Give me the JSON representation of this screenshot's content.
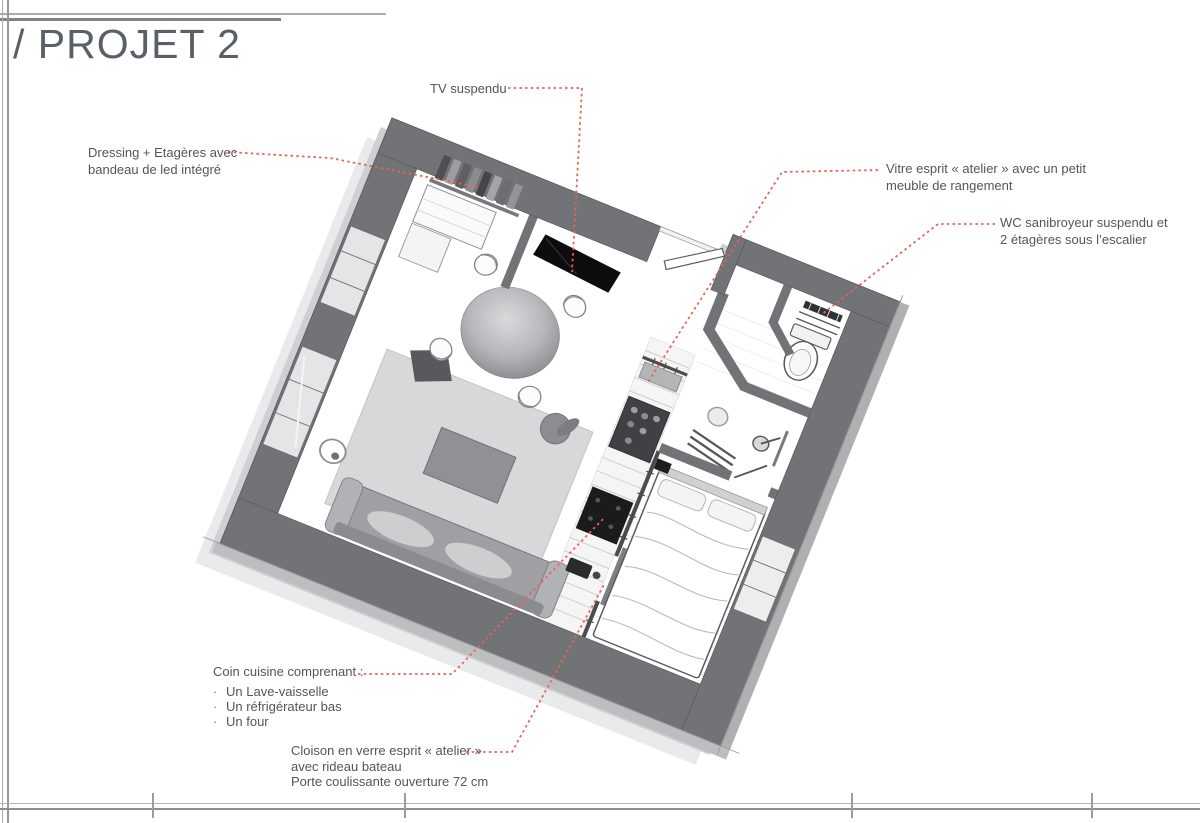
{
  "page": {
    "title": "/ PROJET 2"
  },
  "annotations": {
    "tv": {
      "text": "TV suspendu"
    },
    "dressing": {
      "line1": "Dressing + Etagères avec",
      "line2": "bandeau de led intégré"
    },
    "vitre": {
      "line1": "Vitre esprit « atelier » avec un petit",
      "line2": "meuble de rangement"
    },
    "wc": {
      "line1": "WC sanibroyeur suspendu et",
      "line2": "2 étagères sous l’escalier"
    },
    "kitchen": {
      "title": "Coin cuisine comprenant :",
      "bullet": "·",
      "items": [
        "Un Lave-vaisselle",
        "Un réfrigérateur bas",
        "Un four"
      ]
    },
    "cloison": {
      "line1": "Cloison en verre esprit « atelier »",
      "line2": "avec rideau bateau",
      "line3": "Porte coulissante ouverture 72 cm"
    }
  },
  "colors": {
    "wall": "#717376",
    "leader_line": "#e96450",
    "annotation_text": "#54555a",
    "rug": "#d7d8da",
    "title_text": "#5a6068"
  }
}
